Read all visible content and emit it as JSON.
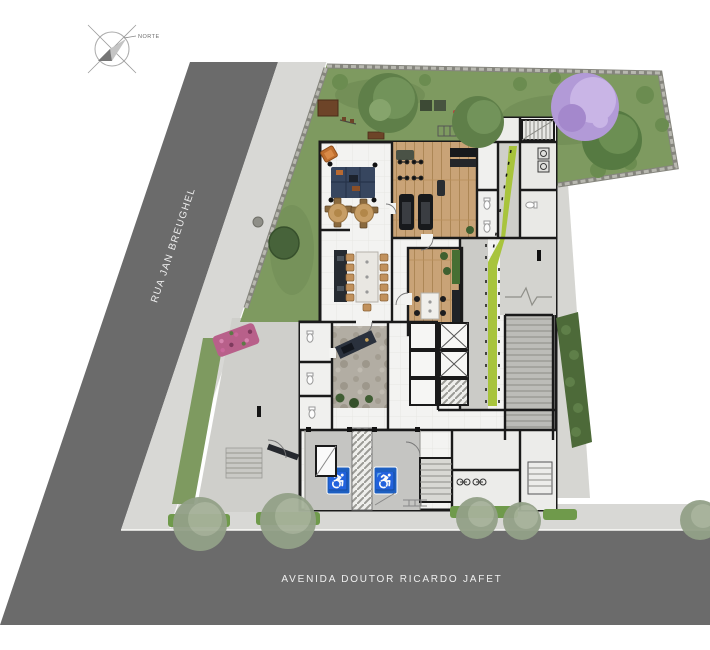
{
  "plan": {
    "compass": {
      "label": "NORTE"
    },
    "streets": {
      "left": {
        "name": "RUA JAN BREUGHEL"
      },
      "bottom": {
        "name": "AVENIDA DOUTOR RICARDO JAFET"
      }
    },
    "icons": {
      "accessible_parking": "♿"
    },
    "colors": {
      "street": "#6b6b6b",
      "sidewalk": "#d8d8d5",
      "plaza": "#cfcfcb",
      "floor": "#f3f3f1",
      "wall": "#1a1a1a",
      "grass": "#7e9a60",
      "grass_dark": "#5e7c47",
      "hedge": "#4d6a39",
      "hedge_bright": "#6f9a4b",
      "street_tree": "#93a188",
      "wood": "#c9a377",
      "stone_floor": "#b2ada3",
      "lime": "#a8c43c",
      "ramp": "#bcbcb8",
      "terrace": "#d3d3cf",
      "purple_tree": "#b29ad7",
      "purple_tree_light": "#c9b5e6",
      "pink_flowers": "#b8608a",
      "navy_sofa": "#37465f",
      "orange_accent": "#c06f2f",
      "planter_brown": "#6d4428",
      "accessible_blue": "#1d5fc1",
      "label_text": "#efefef",
      "compass_text": "#6b6b6b"
    }
  }
}
